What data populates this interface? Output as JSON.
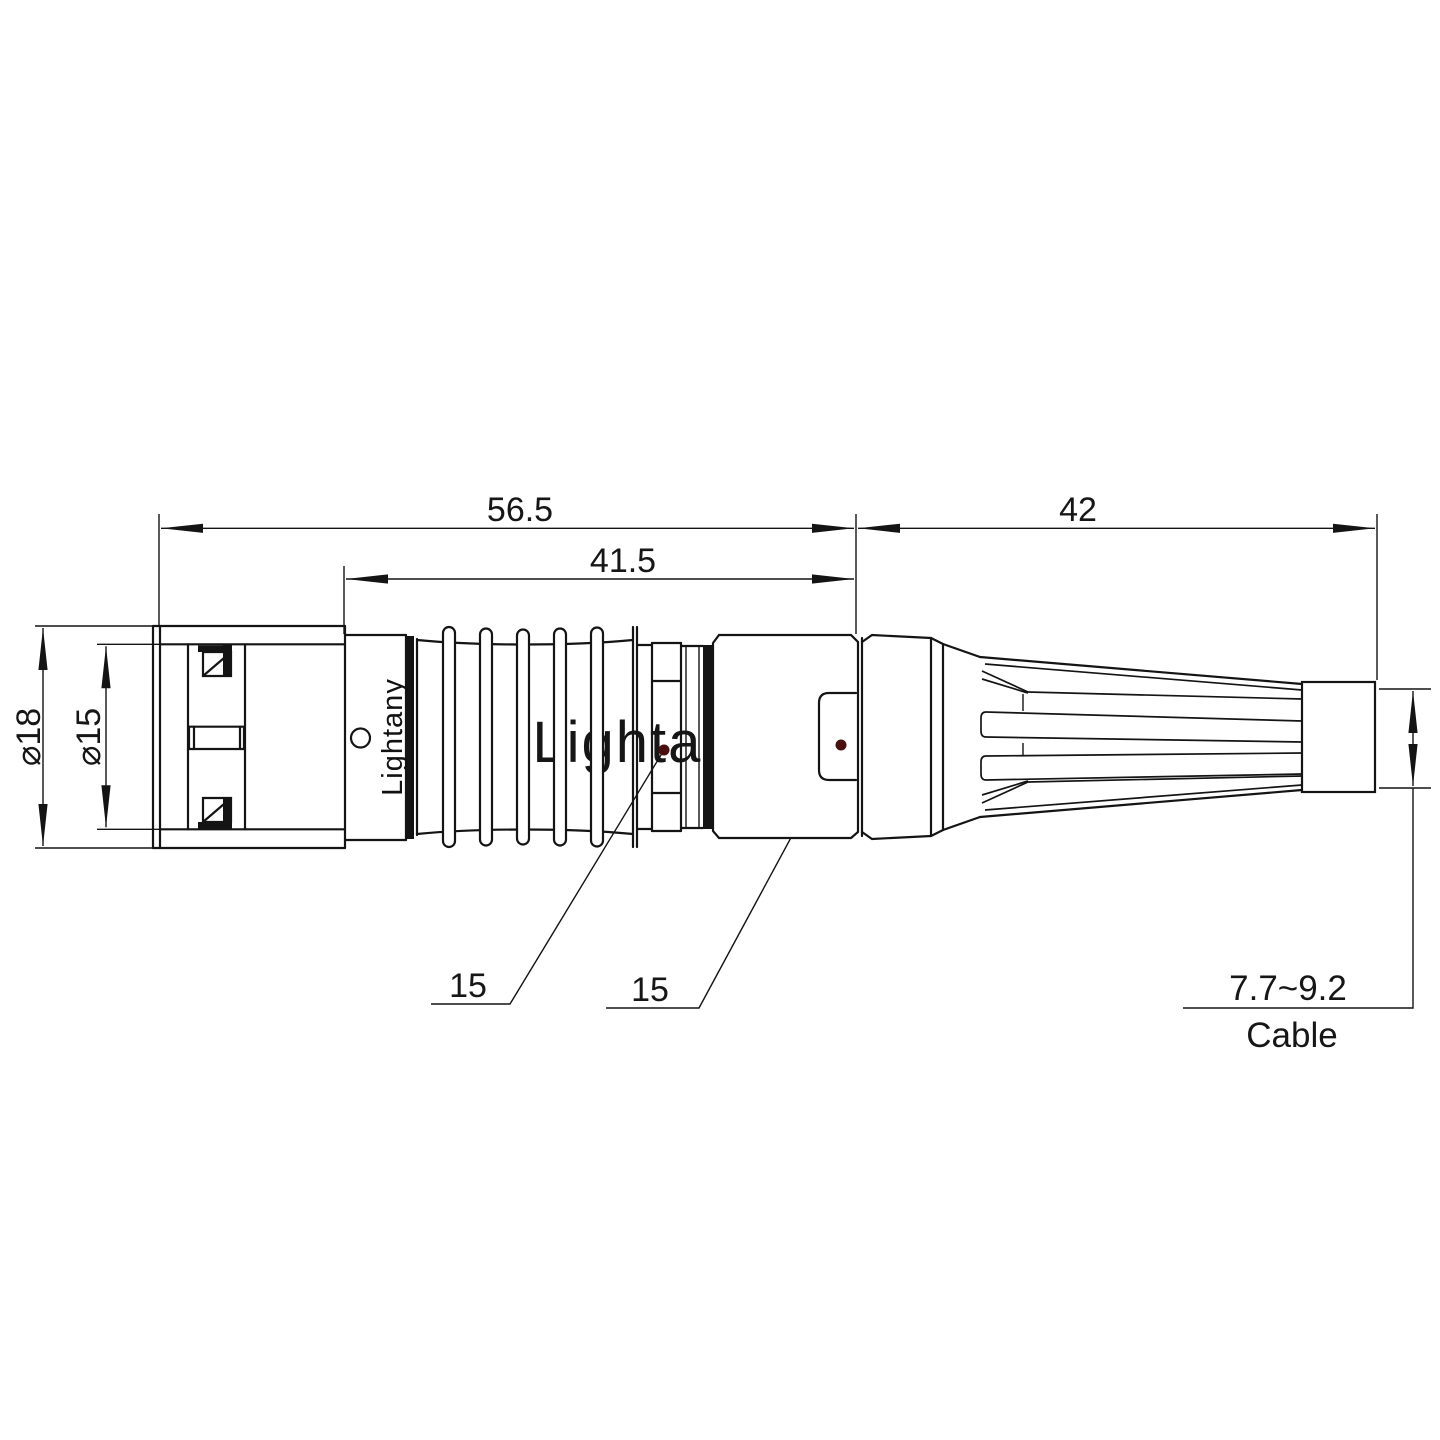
{
  "drawing": {
    "dimensions": {
      "overall_length": "56.5",
      "front_section_length": "41.5",
      "boot_length": "42",
      "shell_diameter": "⌀18",
      "coupling_diameter": "⌀15",
      "nut_width_front": "15",
      "nut_width_rear": "15",
      "cable_diameter_range": "7.7~9.2",
      "cable_label": "Cable"
    },
    "branding": {
      "body_logo": "Lightany",
      "watermark": "Lightany"
    },
    "colors": {
      "line": "#141414",
      "leader_dot": "#4a0e0e",
      "watermark_pink": "#f2c7c7"
    }
  }
}
